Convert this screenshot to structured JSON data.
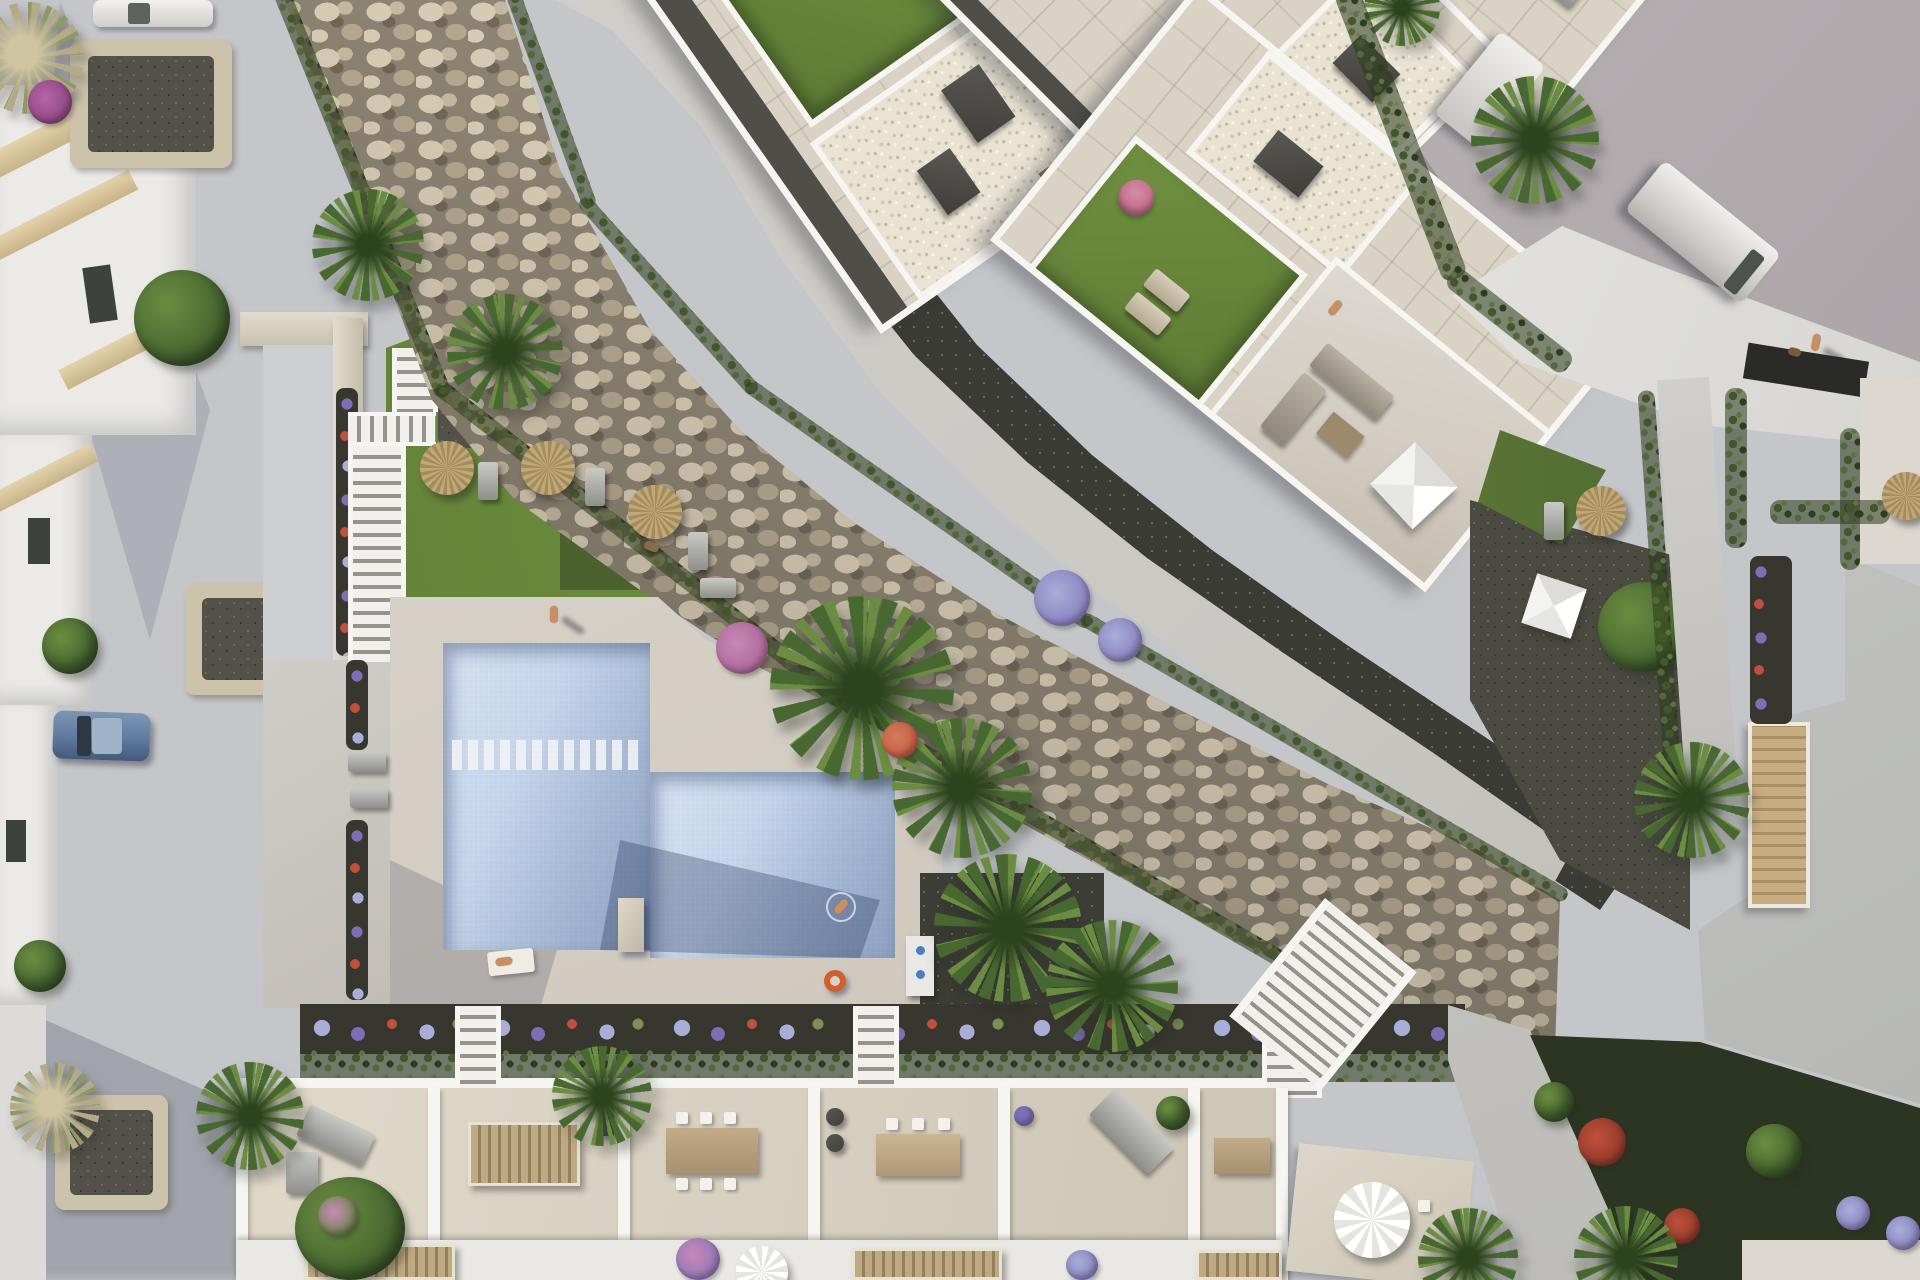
{
  "scene": {
    "kind": "aerial-architectural-rendering",
    "subject": "Bird's-eye 3D render of a modern white residential development: diagonal apartment block with private roof terraces and lawns, communal garden with L-shaped swimming pool and straw parasols, riprap rock slope crossing the site, perimeter streets with parked vehicles, and a row of townhouse patios along the bottom",
    "lighting": "low warm sun casting long soft shadows",
    "text_content": "none - image contains no visible text"
  },
  "colors": {
    "street": "#c5c6ca",
    "road": "#b2abae",
    "roadLight": "#c3bcbe",
    "facade": "#ebeae7",
    "slab": "#d8c49c",
    "windowDark": "#3e423f",
    "stoneRing": "#cdc3ab",
    "gravelDark": "#54514a",
    "rockBase": "#8a8171",
    "rockLight": "#d5cab3",
    "rockMid": "#b2a68e",
    "rockDark": "#6e6557",
    "hedge": "#44572c",
    "hedgeDark": "#2f3d1f",
    "walkLight": "#cac8c3",
    "walkDark": "#3b3b36",
    "wallWhite": "#f6f5f2",
    "tile": "#d9d2c5",
    "tileShade": "#bcb6ab",
    "lawn": "#5e7b35",
    "lawnBright": "#6f9040",
    "lawnShade": "#42582a",
    "gravelWhite": "#e9e3d4",
    "charcoal": "#4e4c47",
    "woodDoor": "#8a6b49",
    "timber": "#c8ad83",
    "pool": "#c2d3ea",
    "poolDeep": "#8ea8cd",
    "deck": "#d8d3cb",
    "parasolStraw": "#c3a877",
    "parasolStrawDark": "#a58c5f",
    "flowerPurple": "#7c6fb5",
    "flowerLilac": "#a9aed9",
    "flowerRed": "#c0503b",
    "flowerPink": "#c889b8",
    "soil": "#38372f",
    "darkGarden": "#2c3522",
    "carBlue": "#5d7aa0",
    "vanWhite": "#e9e9e7",
    "skin": "#c98e62",
    "palmA": "#486831",
    "palmB": "#6b8d41",
    "palmCore": "#2c441e",
    "pampas": "#b4aa88"
  },
  "objects": {
    "buildings": [
      "apartment-block-with-roof-terraces",
      "right-villa-with-flat-roof-and-driveway-canopy",
      "left-townhouse-facades",
      "bottom-townhouse-patio-row"
    ],
    "pool": {
      "shape": "L-shaped",
      "features": [
        "entry-steps",
        "diving-block",
        "swimmer",
        "orange-float-ring",
        "pool-shower"
      ]
    },
    "parasols": {
      "straw": 5,
      "white-round": 2,
      "white-pyramid-awnings": 2
    },
    "vehicles": [
      "white-car-top-left",
      "blue-car-left-street",
      "white-van-road",
      "white-van-road-small"
    ],
    "people": [
      "sunbather-on-deck",
      "walker-on-deck",
      "swimmer-in-pool",
      "person-on-roof-terrace",
      "person-on-big-terrace",
      "pedestrian-on-road"
    ],
    "animals": [
      "dog-on-lawn",
      "dog-on-road"
    ],
    "landscape": [
      "riprap-rock-slope",
      "hedge-rows",
      "lawn-garden-with-loungers",
      "flower-beds-purple-red",
      "palm-trees",
      "stone-edged-gravel-beds",
      "white-garden-stairs",
      "timber-deck-ramp",
      "dark-gravel-garden"
    ]
  }
}
